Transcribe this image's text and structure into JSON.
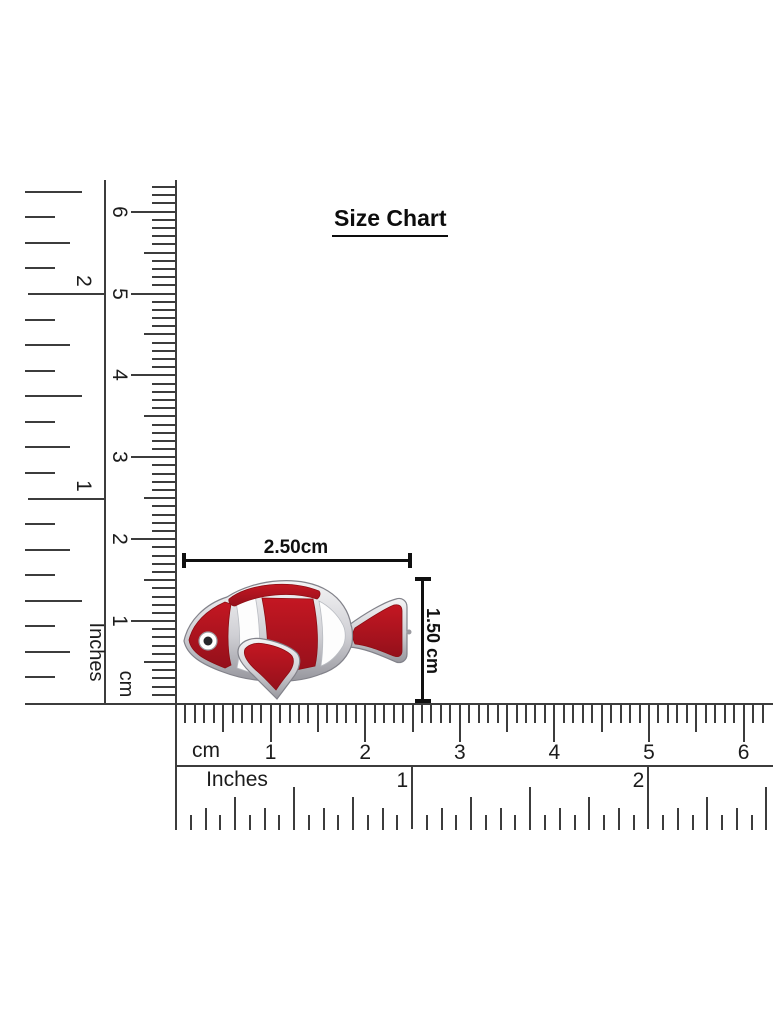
{
  "title": {
    "text": "Size Chart"
  },
  "product": {
    "name": "red-clownfish-enamel-charm",
    "description": "Clownfish charm with silver outline, red enamel body, white stripes",
    "width_label": "2.50cm",
    "height_label": "1.50 cm"
  },
  "left_rulers": {
    "inches": {
      "unit_label": "Inches",
      "numbers": [
        "1",
        "2"
      ]
    },
    "cm": {
      "unit_label": "cm",
      "numbers": [
        "1",
        "2",
        "3",
        "4",
        "5",
        "6"
      ]
    }
  },
  "bottom_rulers": {
    "cm": {
      "unit_label": "cm",
      "numbers": [
        "1",
        "2",
        "3",
        "4",
        "5",
        "6"
      ]
    },
    "inches": {
      "unit_label": "Inches",
      "numbers": [
        "1",
        "2"
      ]
    }
  },
  "colors": {
    "ink": "#101010",
    "tick": "#3c3c3c",
    "red": "#b11218",
    "red_dark": "#8c0d13",
    "red_bright": "#c41722",
    "white_enamel": "#fdfdfd",
    "silver_light": "#f2f2f3",
    "silver_dark": "#9b9ba1",
    "silver_stroke": "#82828a",
    "pupil": "#26262a"
  }
}
